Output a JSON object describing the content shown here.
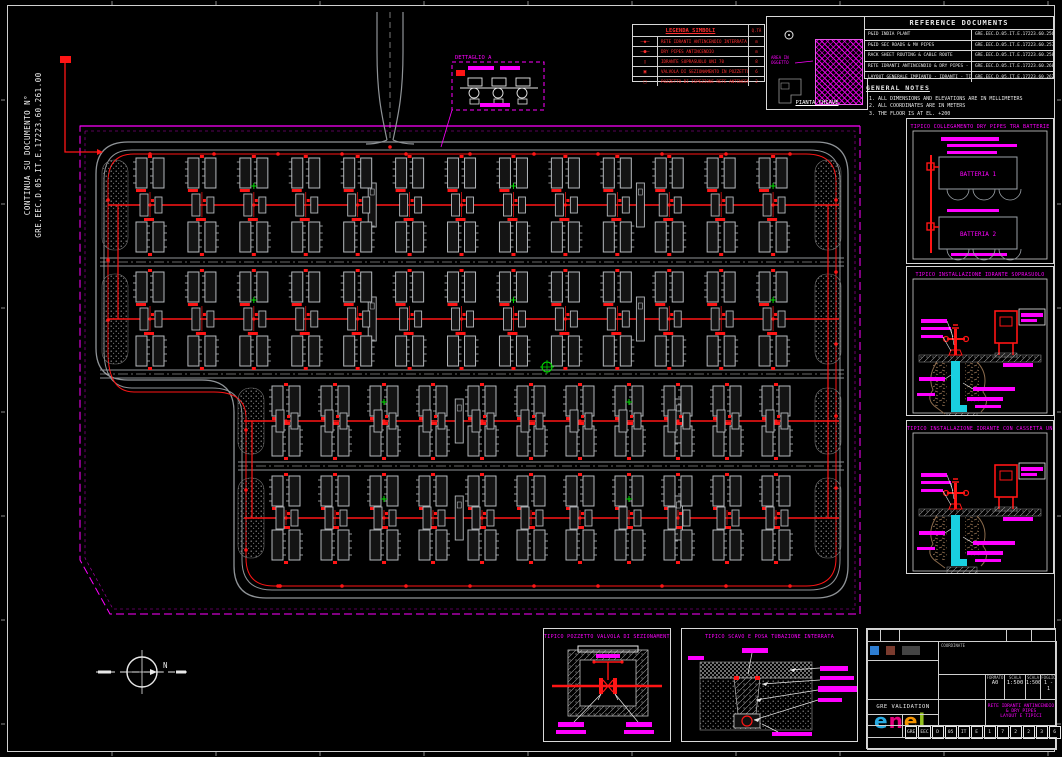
{
  "left_note": {
    "line1": "CONTINUA SU DOCUMENTO N°",
    "line2": "GRE.EEC.D.05.IT.E.17223.60.261.00"
  },
  "legend": {
    "title": "LEGENDA SIMBOLI",
    "qty_header": "Q.TÀ",
    "rows": [
      {
        "symbol": "—◆—",
        "label": "RETE IDRANTI ANTINCENDIO INTERRATA",
        "qty": "m"
      },
      {
        "symbol": "—●—",
        "label": "DRY PIPES ANTINCENDIO",
        "qty": "m"
      },
      {
        "symbol": "▯",
        "label": "IDRANTE SOPRASUOLO UNI 70",
        "qty": "8"
      },
      {
        "symbol": "▣",
        "label": "VALVOLA DI SEZIONAMENTO IN POZZETTO",
        "qty": "6"
      },
      {
        "symbol": "□",
        "label": "POZZETTO DI ISPEZIONE RETE ANTINCENDIO",
        "qty": "2"
      }
    ]
  },
  "key_plan": {
    "area_label_1": "AREA IN",
    "area_label_2": "OGGETTO",
    "caption": "PIANTA CHIAVE"
  },
  "reference_documents": {
    "title": "REFERENCE DOCUMENTS",
    "rows": [
      {
        "title": "P&ID INDIA PLANT",
        "doc": "GRE.EEC.D.05.IT.E.17223.60.256.00"
      },
      {
        "title": "P&ID SEC ROADS & MV PIPES",
        "doc": "GRE.EEC.D.05.IT.E.17223.60.257.00"
      },
      {
        "title": "RACK SHEET ROUTING & CABLE ROUTE",
        "doc": "GRE.EEC.D.05.IT.E.17223.60.258.00"
      },
      {
        "title": "RETE IDRANTI ANTINCENDIO & DRY PIPES - KEY PLAN",
        "doc": "GRE.EEC.D.05.IT.E.17223.60.260.00"
      },
      {
        "title": "LAYOUT GENERALE IMPIANTO - IDRANTI - TIPICI",
        "doc": "GRE.EEC.D.05.IT.E.17223.60.262.00"
      }
    ]
  },
  "general_notes": {
    "title": "GENERAL NOTES",
    "items": [
      "ALL DIMENSIONS AND ELEVATIONS ARE IN MILLIMETERS",
      "ALL COORDINATES ARE IN METERS",
      "THE FLOOR IS AT EL. +200"
    ]
  },
  "pump_detail": {
    "label": "DETTAGLIO A"
  },
  "panels": {
    "p1": {
      "title": "TIPICO COLLEGAMENTO DRY PIPES TRA BATTERIE",
      "unit1": "BATTERIA 1",
      "unit2": "BATTERIA 2"
    },
    "p2": {
      "title": "TIPICO INSTALLAZIONE IDRANTE SOPRASUOLO"
    },
    "p3": {
      "title": "TIPICO INSTALLAZIONE IDRANTE CON CASSETTA UNI 70"
    }
  },
  "bottom_details": {
    "b1": {
      "title": "TIPICO POZZETTO VALVOLA DI SEZIONAMENTO"
    },
    "b2": {
      "title": "TIPICO SCAVO E POSA TUBAZIONE INTERRATA"
    }
  },
  "north": {
    "label": "N"
  },
  "title_block": {
    "coordination": "COORDINATE",
    "validation": "GRE VALIDATION",
    "logo_letters": [
      {
        "ch": "e",
        "color": "#29abe2"
      },
      {
        "ch": "n",
        "color": "#e6007e"
      },
      {
        "ch": "e",
        "color": "#f39200"
      },
      {
        "ch": "l",
        "color": "#94c11f"
      }
    ],
    "format_h": "FORMATO",
    "scale_h": "SCALA",
    "sheet_h": "FOGLIO",
    "format": "A0",
    "scale1": "1:500",
    "scale2": "1:500",
    "sheet": "1 - 1",
    "title_line1": "RETE IDRANTI ANTINCENDIO & DRY PIPES",
    "title_line2": "LAYOUT E TIPICI",
    "doc_cells": [
      "GRE",
      "EEC",
      "D",
      "05",
      "IT",
      "E",
      "1",
      "7",
      "2",
      "2",
      "3",
      "6",
      "0",
      "2",
      "6",
      "2",
      "0",
      "0"
    ]
  },
  "plan": {
    "road_color": "#8f9397",
    "unit_color": "#b4b8bc",
    "fire_color": "#ff1515",
    "boundary_color": "#ff00ff",
    "marker_color": "#00dd00",
    "bands": [
      {
        "x": 100,
        "y": 152,
        "w": 745,
        "h": 106,
        "clusters": 13
      },
      {
        "x": 100,
        "y": 266,
        "w": 745,
        "h": 106,
        "clusters": 13
      },
      {
        "x": 236,
        "y": 380,
        "w": 609,
        "h": 82,
        "clusters": 11
      },
      {
        "x": 236,
        "y": 470,
        "w": 609,
        "h": 96,
        "clusters": 11
      }
    ]
  }
}
